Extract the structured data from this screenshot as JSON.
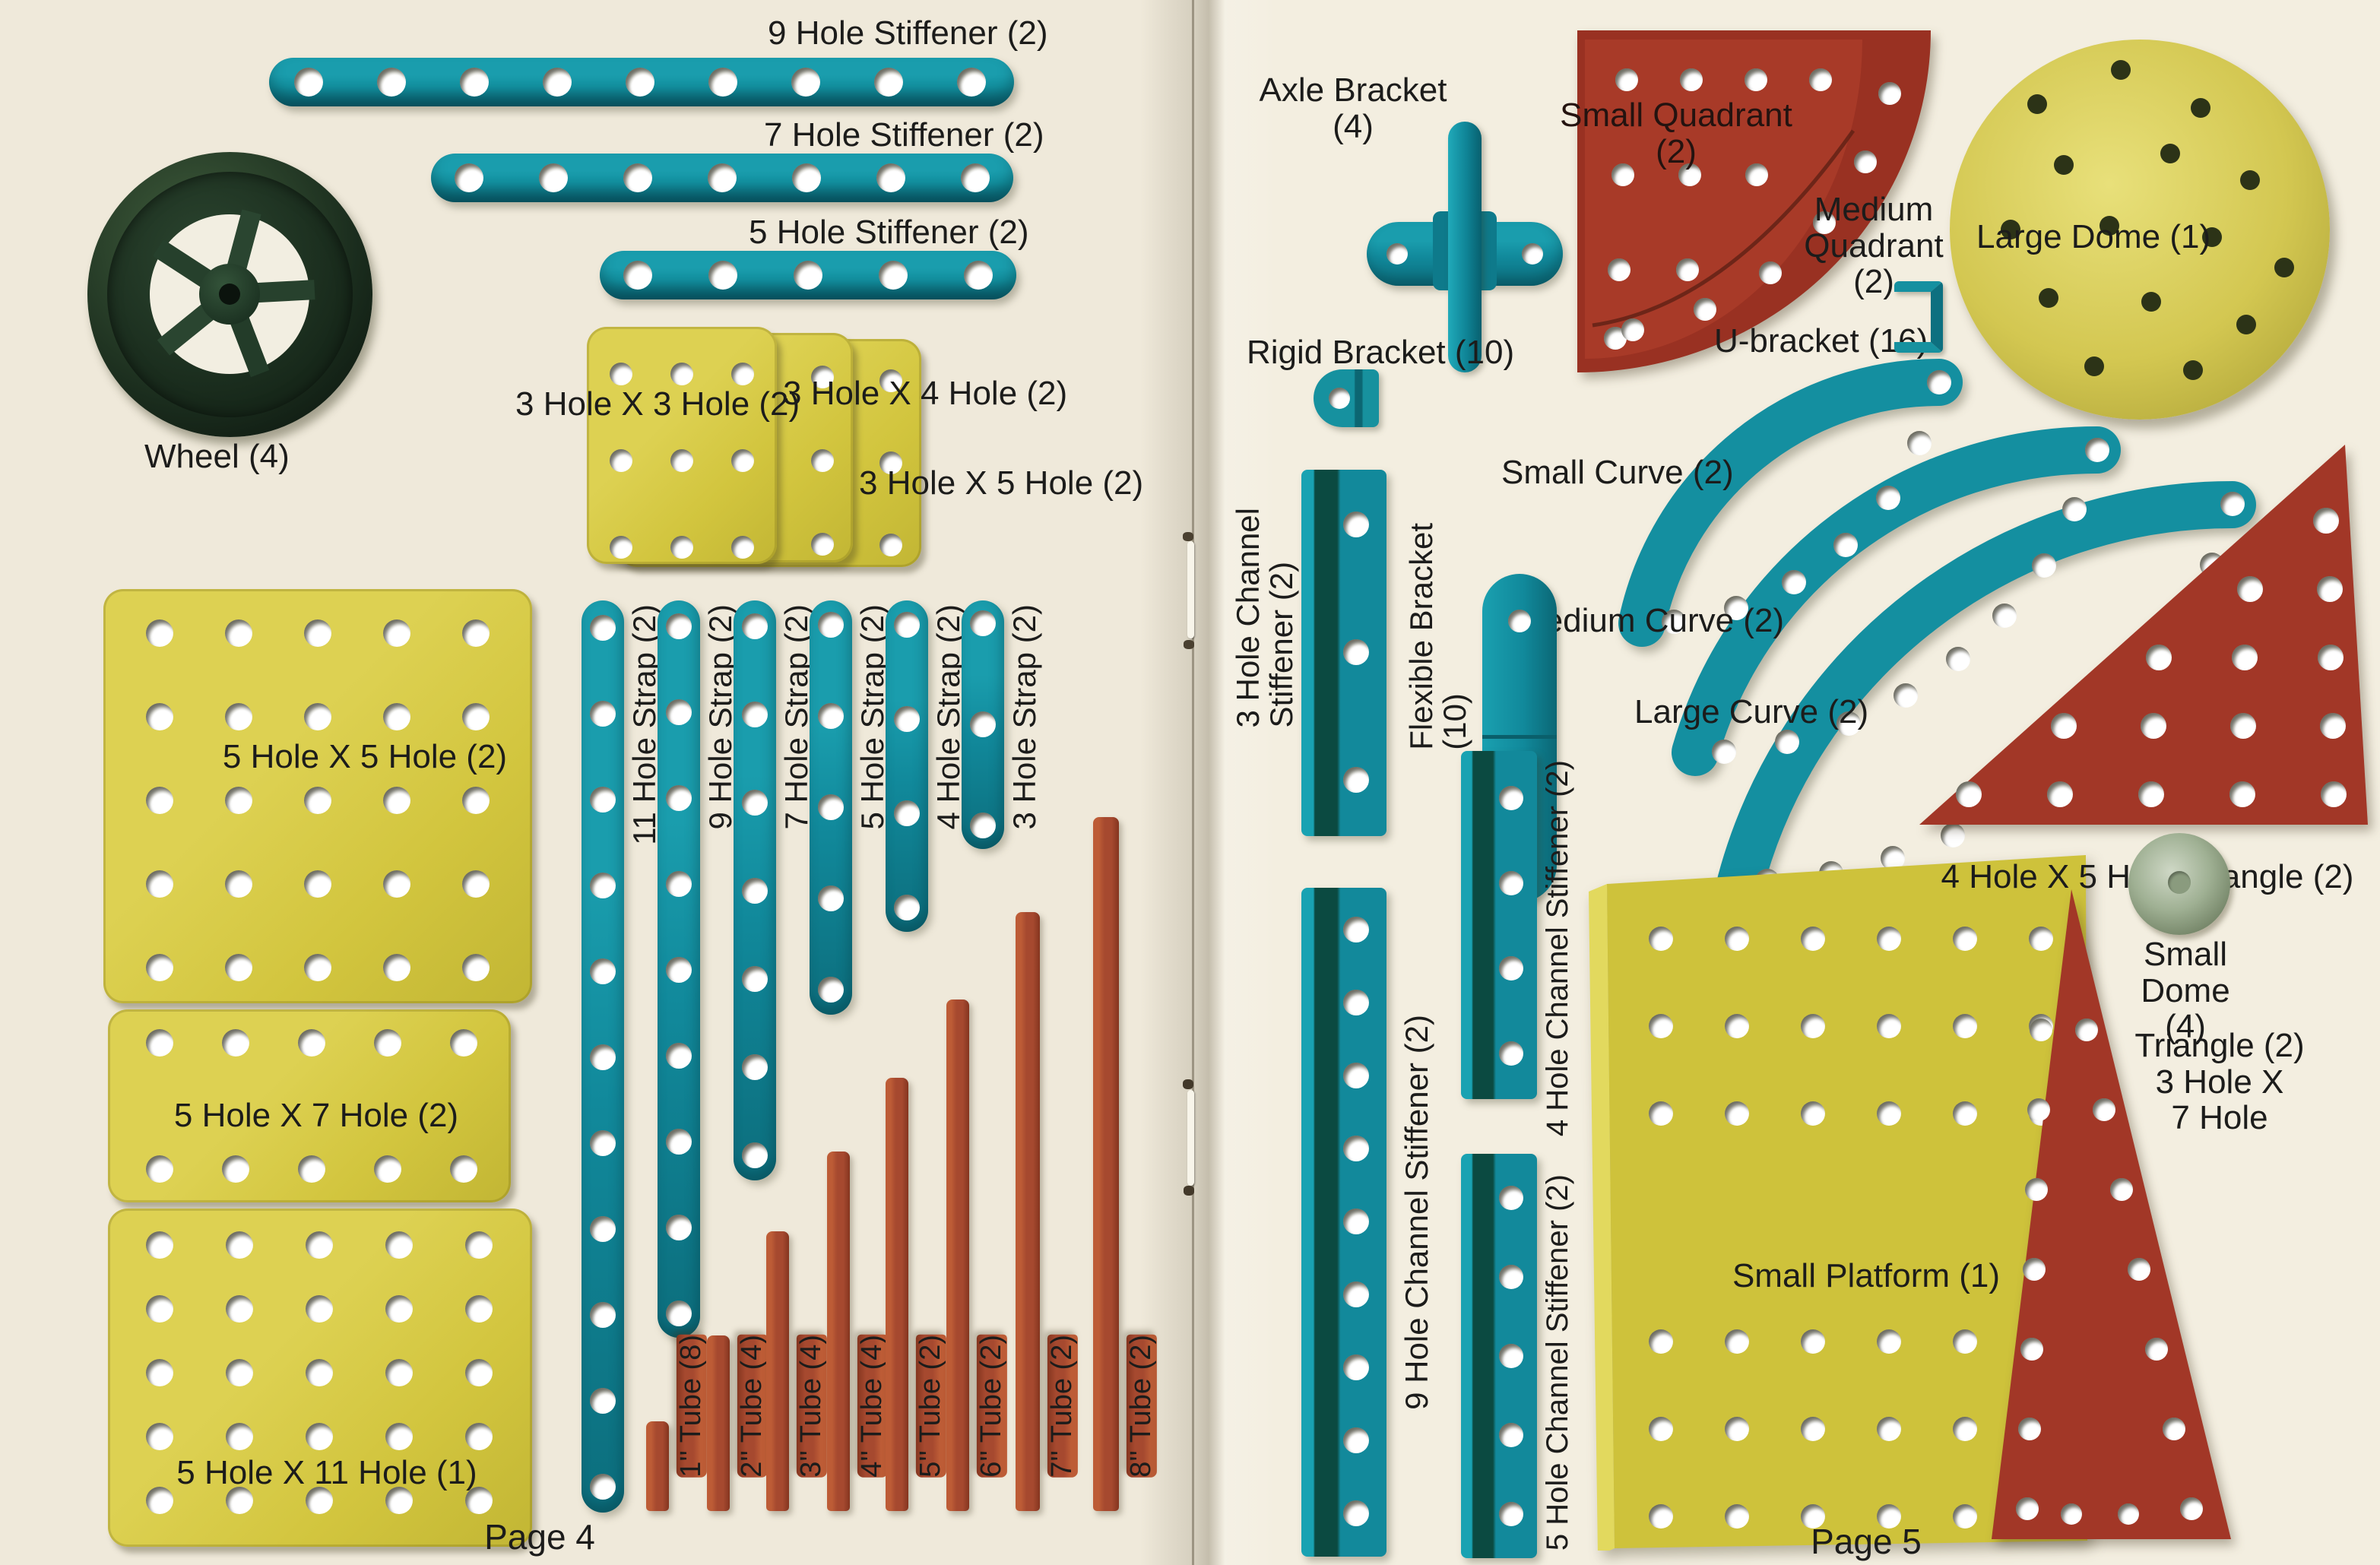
{
  "colors": {
    "teal": "#11899b",
    "yellow": "#d5c83e",
    "red": "#a23a28",
    "tube_red": "#a6492f",
    "paper": "#f0ebdc",
    "ink": "#1c1c1b"
  },
  "left": {
    "page_label": "Page 4",
    "wheel_label": "Wheel (4)",
    "stiffeners": [
      {
        "label": "9 Hole Stiffener (2)"
      },
      {
        "label": "7 Hole Stiffener (2)"
      },
      {
        "label": "5 Hole Stiffener (2)"
      }
    ],
    "small_plates": [
      {
        "label": "3 Hole X 3 Hole (2)"
      },
      {
        "label": "3 Hole X 4 Hole (2)"
      },
      {
        "label": "3 Hole X 5 Hole (2)"
      }
    ],
    "large_plates": [
      {
        "label": "5 Hole X 5 Hole (2)"
      },
      {
        "label": "5 Hole X 7 Hole (2)"
      },
      {
        "label": "5 Hole X 11 Hole (1)"
      }
    ],
    "straps": [
      {
        "label": "11 Hole Strap (2)"
      },
      {
        "label": "9 Hole Strap (2)"
      },
      {
        "label": "7 Hole Strap (2)"
      },
      {
        "label": "5 Hole Strap (2)"
      },
      {
        "label": "4 Hole Strap (2)"
      },
      {
        "label": "3 Hole Strap (2)"
      }
    ],
    "tubes": [
      {
        "label": "1'' Tube (8)"
      },
      {
        "label": "2'' Tube (4)"
      },
      {
        "label": "3'' Tube (4)"
      },
      {
        "label": "4'' Tube (4)"
      },
      {
        "label": "5'' Tube (2)"
      },
      {
        "label": "6'' Tube (2)"
      },
      {
        "label": "7'' Tube (2)"
      },
      {
        "label": "8'' Tube (2)"
      }
    ]
  },
  "right": {
    "page_label": "Page 5",
    "axle_bracket_lines": [
      "Axle Bracket",
      "(4)"
    ],
    "small_quadrant_lines": [
      "Small Quadrant",
      "(2)"
    ],
    "medium_quadrant_lines": [
      "Medium",
      "Quadrant",
      "(2)"
    ],
    "large_dome_label": "Large Dome (1)",
    "rigid_bracket_label": "Rigid Bracket (10)",
    "u_bracket_label": "U-bracket (16)",
    "small_curve_label": "Small Curve (2)",
    "medium_curve_label": "Medium Curve (2)",
    "large_curve_label": "Large Curve (2)",
    "ch3_lines": [
      "3 Hole Channel",
      "Stiffener (2)"
    ],
    "flexible_lines": [
      "Flexible Bracket",
      "(10)"
    ],
    "ch9_label": "9 Hole Channel Stiffener (2)",
    "ch4_label": "4 Hole Channel Stiffener (2)",
    "ch5_label": "5 Hole Channel Stiffener (2)",
    "triangle45_label": "4 Hole X 5 Hole Triangle (2)",
    "small_platform_label": "Small Platform (1)",
    "small_dome_lines": [
      "Small",
      "Dome (4)"
    ],
    "triangle37_lines": [
      "Triangle (2)",
      "3 Hole X",
      "7 Hole"
    ]
  }
}
